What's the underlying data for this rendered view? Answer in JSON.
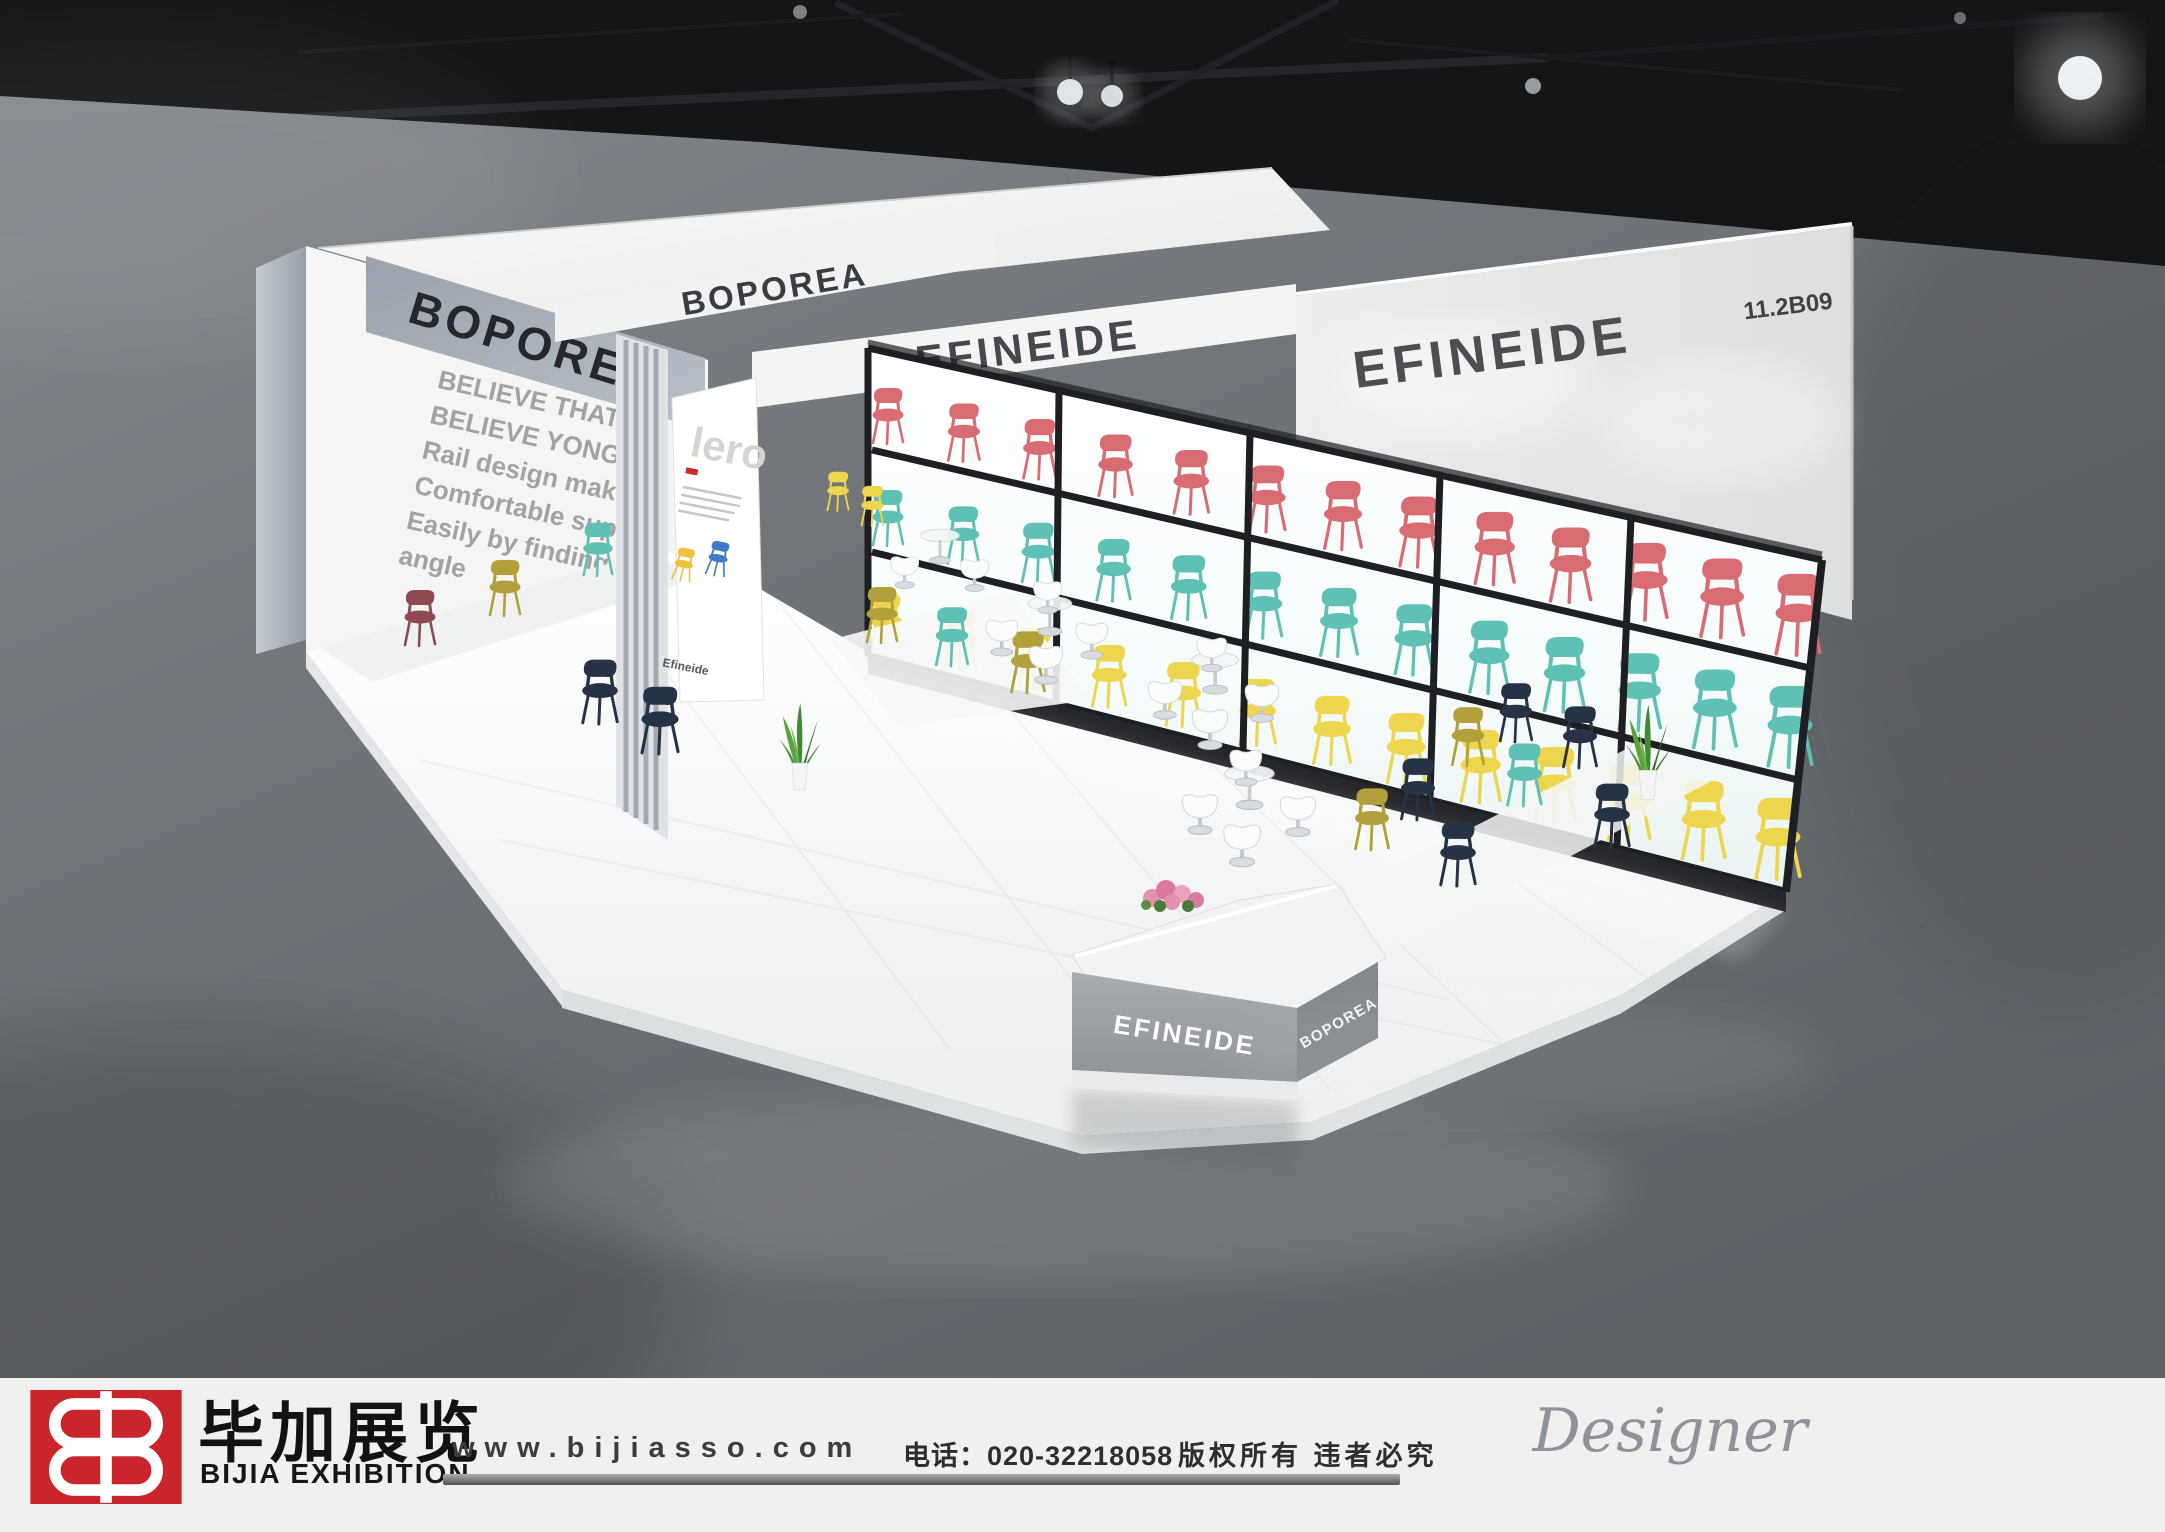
{
  "scene": {
    "booth_number": "11.2B09",
    "brands": {
      "left_beam": "BOPOREA",
      "top_band": "BOPOREA",
      "center_beam": "EFINEIDE",
      "right_wall": "EFINEIDE"
    },
    "wall_text": {
      "lines": [
        "BELIEVE THAT",
        "BELIEVE YONGF",
        "Rail design mak",
        "Comfortable sup",
        "Easily by finding",
        "angle"
      ]
    },
    "poster": {
      "title": "lero",
      "brand": "Efineide"
    },
    "desk": {
      "front": "EFINEIDE",
      "side": "BOPOREA"
    },
    "palette": {
      "chair_red": "#d96b72",
      "chair_teal": "#5fc0b6",
      "chair_yellow": "#eed54e",
      "chair_olive": "#b2a03b",
      "chair_navy": "#263246",
      "chair_maroon": "#8e4a50",
      "poster_yellow": "#eec23f",
      "poster_blue": "#3f7ac8",
      "logo_red": "#c9252b"
    },
    "shelf_rows": [
      {
        "color_key": "chair_red",
        "count": 13
      },
      {
        "color_key": "chair_teal",
        "count": 13
      },
      {
        "color_key": "chair_yellow",
        "count": 13
      }
    ]
  },
  "footer": {
    "company_cn": "毕加展览",
    "company_en": "BIJIA EXHIBITION",
    "website": "www.bijiasso.com",
    "phone": "电话：020-32218058",
    "copyright": "版权所有 违者必究",
    "signature": "Designer"
  }
}
